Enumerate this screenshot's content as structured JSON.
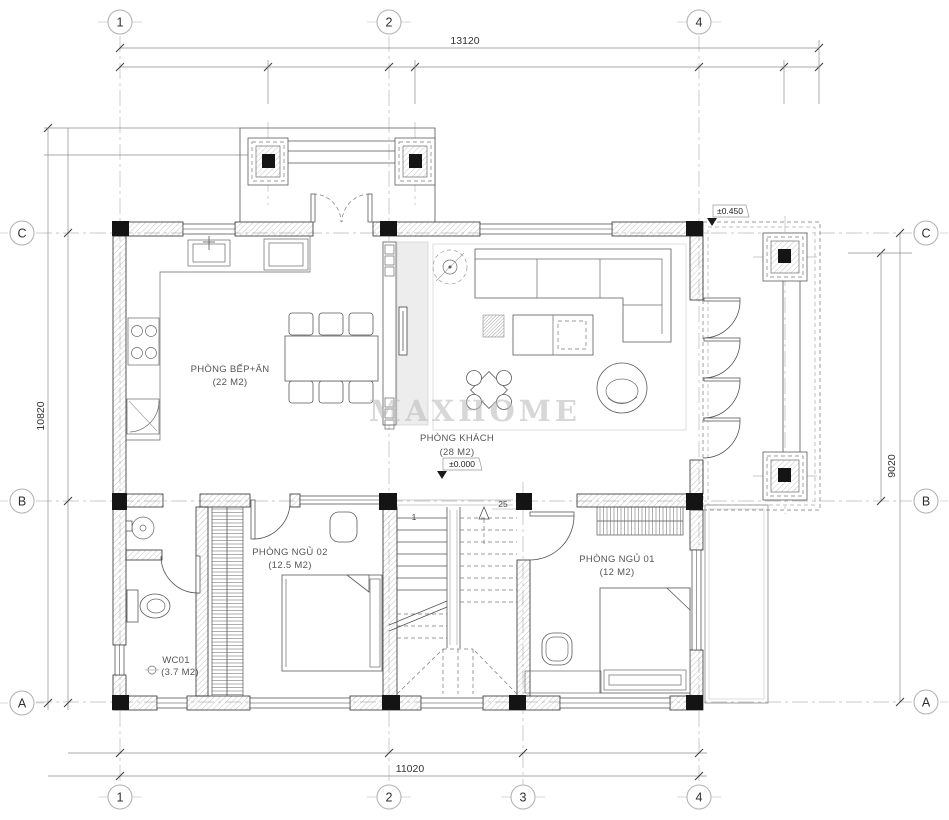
{
  "watermark": "MAXHOME",
  "grid_bubbles": {
    "top": [
      {
        "label": "1"
      },
      {
        "label": "2"
      },
      {
        "label": "4"
      }
    ],
    "bottom": [
      {
        "label": "1"
      },
      {
        "label": "2"
      },
      {
        "label": "3"
      },
      {
        "label": "4"
      }
    ],
    "left": [
      {
        "label": "C"
      },
      {
        "label": "B"
      },
      {
        "label": "A"
      }
    ],
    "right": [
      {
        "label": "C"
      },
      {
        "label": "B"
      },
      {
        "label": "A"
      }
    ]
  },
  "dimensions": {
    "top_overall": "13120",
    "bottom_overall": "11020",
    "left_overall": "10820",
    "right_overall": "9020"
  },
  "levels": {
    "porch": "±0.450",
    "living": "±0.000"
  },
  "stairs": {
    "start_number": "1",
    "riser_count": "25"
  },
  "rooms": {
    "kitchen_dining": {
      "name": "PHÒNG BẾP+ĂN",
      "area": "(22 M2)"
    },
    "living": {
      "name": "PHÒNG KHÁCH",
      "area": "(28 M2)"
    },
    "bedroom_02": {
      "name": "PHÒNG NGỦ 02",
      "area": "(12.5 M2)"
    },
    "bedroom_01": {
      "name": "PHÒNG NGỦ 01",
      "area": "(12 M2)"
    },
    "wc_01": {
      "name": "WC01",
      "area": "(3.7 M2)"
    }
  },
  "colors": {
    "wall_line": "#2e2e2e",
    "column_fill": "#141414",
    "grid_line": "#b8b8b8",
    "watermark": "#bdbdbd"
  }
}
